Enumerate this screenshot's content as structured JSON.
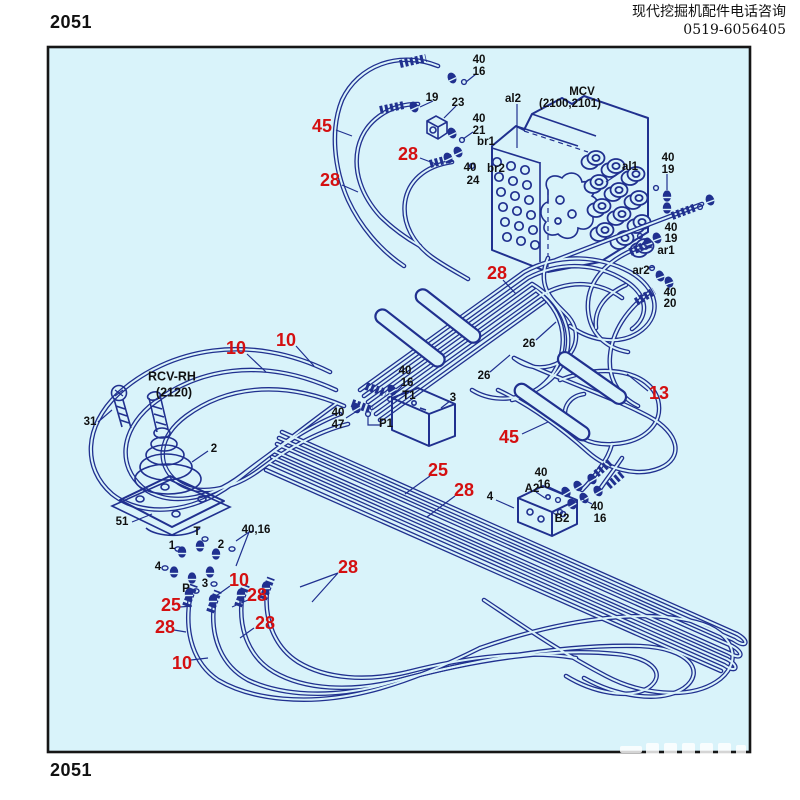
{
  "page": {
    "number_top": "2051",
    "number_bottom": "2051"
  },
  "header": {
    "line1": "现代挖掘机配件电话咨询",
    "line2": "0519-6056405"
  },
  "colors": {
    "panel_fill": "#d9f3fa",
    "line_navy": "#20308f",
    "callout_red": "#d40f10",
    "text_black": "#101010"
  },
  "diagram": {
    "labels": [
      {
        "t": "45",
        "x": 322,
        "y": 127,
        "c": "red"
      },
      {
        "t": "28",
        "x": 408,
        "y": 155,
        "c": "red"
      },
      {
        "t": "28",
        "x": 330,
        "y": 181,
        "c": "red"
      },
      {
        "t": "28",
        "x": 497,
        "y": 274,
        "c": "red"
      },
      {
        "t": "10",
        "x": 236,
        "y": 349,
        "c": "red"
      },
      {
        "t": "10",
        "x": 286,
        "y": 341,
        "c": "red"
      },
      {
        "t": "13",
        "x": 659,
        "y": 394,
        "c": "red"
      },
      {
        "t": "45",
        "x": 509,
        "y": 438,
        "c": "red"
      },
      {
        "t": "25",
        "x": 438,
        "y": 471,
        "c": "red"
      },
      {
        "t": "28",
        "x": 464,
        "y": 491,
        "c": "red"
      },
      {
        "t": "28",
        "x": 348,
        "y": 568,
        "c": "red"
      },
      {
        "t": "10",
        "x": 239,
        "y": 581,
        "c": "red"
      },
      {
        "t": "28",
        "x": 257,
        "y": 596,
        "c": "red"
      },
      {
        "t": "25",
        "x": 171,
        "y": 606,
        "c": "red"
      },
      {
        "t": "28",
        "x": 165,
        "y": 628,
        "c": "red"
      },
      {
        "t": "28",
        "x": 265,
        "y": 624,
        "c": "red"
      },
      {
        "t": "10",
        "x": 182,
        "y": 664,
        "c": "red"
      },
      {
        "t": "40",
        "x": 479,
        "y": 60
      },
      {
        "t": "16",
        "x": 479,
        "y": 72
      },
      {
        "t": "19",
        "x": 432,
        "y": 98
      },
      {
        "t": "23",
        "x": 458,
        "y": 103
      },
      {
        "t": "40",
        "x": 479,
        "y": 119
      },
      {
        "t": "21",
        "x": 479,
        "y": 131
      },
      {
        "t": "br1",
        "x": 486,
        "y": 142
      },
      {
        "t": "40",
        "x": 470,
        "y": 168
      },
      {
        "t": "br2",
        "x": 496,
        "y": 169
      },
      {
        "t": "24",
        "x": 473,
        "y": 181
      },
      {
        "t": "al2",
        "x": 513,
        "y": 99
      },
      {
        "t": "MCV",
        "x": 582,
        "y": 92,
        "a": "start"
      },
      {
        "t": "(2100,2101)",
        "x": 570,
        "y": 104,
        "a": "start"
      },
      {
        "t": "al1",
        "x": 630,
        "y": 167
      },
      {
        "t": "40",
        "x": 668,
        "y": 158
      },
      {
        "t": "19",
        "x": 668,
        "y": 170
      },
      {
        "t": "40",
        "x": 671,
        "y": 228
      },
      {
        "t": "19",
        "x": 671,
        "y": 239
      },
      {
        "t": "ar1",
        "x": 666,
        "y": 251
      },
      {
        "t": "ar2",
        "x": 641,
        "y": 271
      },
      {
        "t": "40",
        "x": 670,
        "y": 293
      },
      {
        "t": "20",
        "x": 670,
        "y": 304
      },
      {
        "t": "26",
        "x": 529,
        "y": 344
      },
      {
        "t": "26",
        "x": 484,
        "y": 376
      },
      {
        "t": "40",
        "x": 405,
        "y": 371
      },
      {
        "t": "16",
        "x": 407,
        "y": 383
      },
      {
        "t": "T1",
        "x": 409,
        "y": 396
      },
      {
        "t": "3",
        "x": 453,
        "y": 398
      },
      {
        "t": "P1",
        "x": 386,
        "y": 424
      },
      {
        "t": "40",
        "x": 338,
        "y": 413
      },
      {
        "t": "47",
        "x": 338,
        "y": 425
      },
      {
        "t": "RCV-RH",
        "x": 172,
        "y": 377,
        "s": 12.5
      },
      {
        "t": "(2120)",
        "x": 174,
        "y": 393,
        "s": 12.5
      },
      {
        "t": "31",
        "x": 90,
        "y": 422
      },
      {
        "t": "2",
        "x": 214,
        "y": 449
      },
      {
        "t": "51",
        "x": 122,
        "y": 522
      },
      {
        "t": "T",
        "x": 197,
        "y": 532
      },
      {
        "t": "1",
        "x": 172,
        "y": 546
      },
      {
        "t": "2",
        "x": 221,
        "y": 545
      },
      {
        "t": "4",
        "x": 158,
        "y": 567
      },
      {
        "t": "P",
        "x": 186,
        "y": 589
      },
      {
        "t": "3",
        "x": 205,
        "y": 584
      },
      {
        "t": "40,16",
        "x": 256,
        "y": 530,
        "a": "start"
      },
      {
        "t": "A2",
        "x": 532,
        "y": 489
      },
      {
        "t": "4",
        "x": 490,
        "y": 497
      },
      {
        "t": "B2",
        "x": 562,
        "y": 519
      },
      {
        "t": "40",
        "x": 541,
        "y": 473
      },
      {
        "t": "16",
        "x": 544,
        "y": 485
      },
      {
        "t": "40",
        "x": 597,
        "y": 507
      },
      {
        "t": "16",
        "x": 600,
        "y": 519
      }
    ]
  }
}
